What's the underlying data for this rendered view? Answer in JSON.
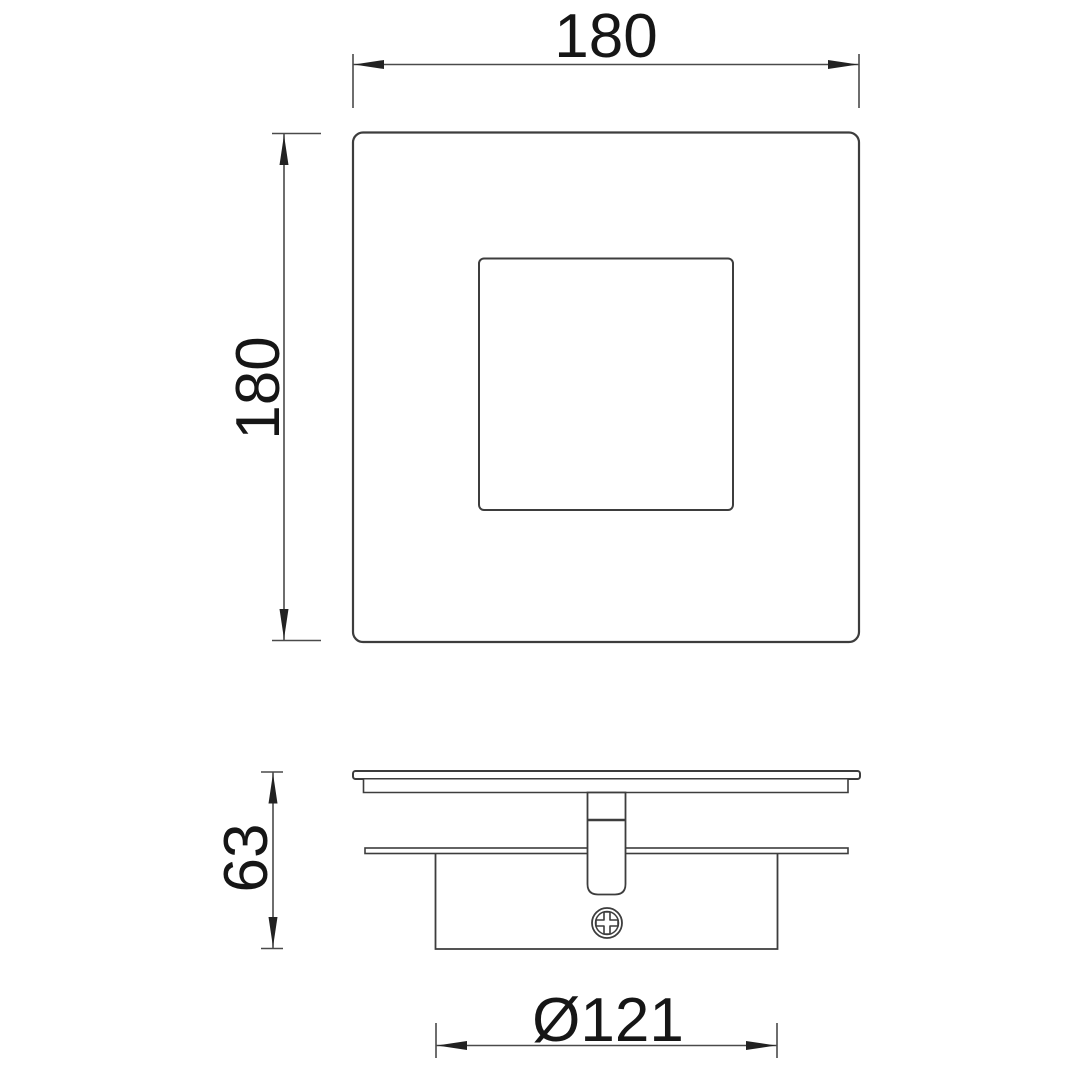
{
  "drawing": {
    "dimensions": {
      "width": {
        "label": "180"
      },
      "height": {
        "label": "180"
      },
      "depth": {
        "label": "63"
      },
      "canopy_diameter": {
        "label": "Ø121"
      }
    },
    "colors": {
      "background": "#ffffff",
      "line": "#3d3d3d",
      "dim_line": "#4a4a4a",
      "text": "#161616"
    }
  }
}
